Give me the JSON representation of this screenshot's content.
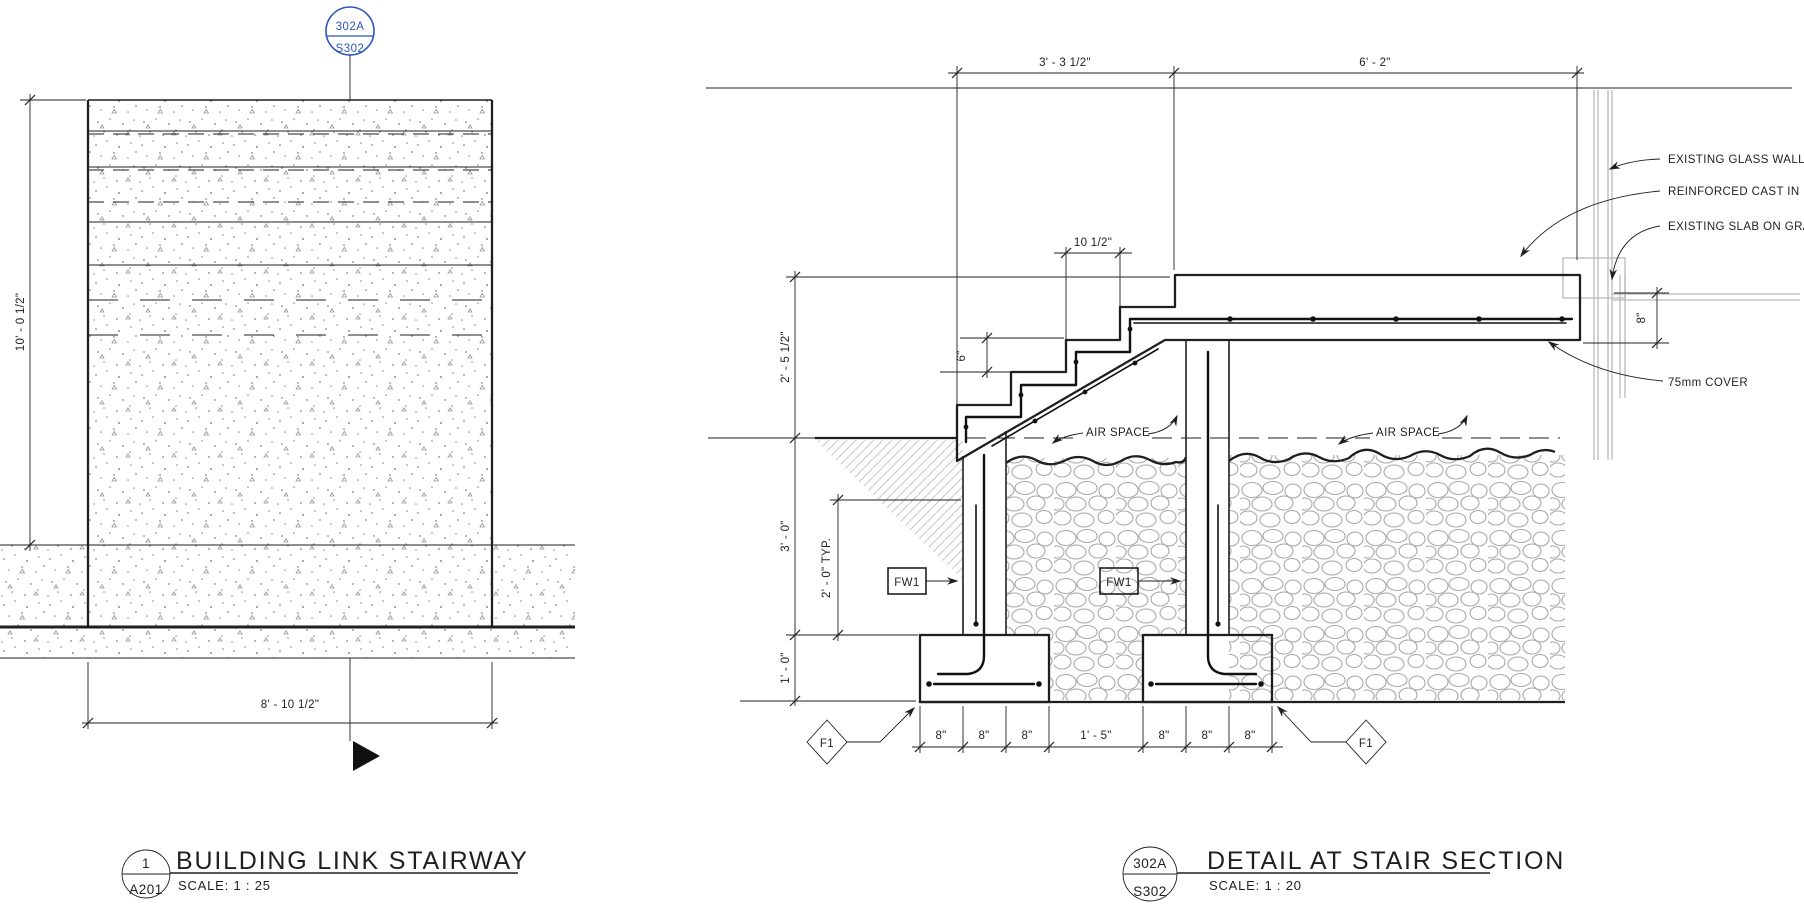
{
  "palette": {
    "ink": "#1f1f1f",
    "blue": "#2e55bd",
    "gray": "#b9b9b9"
  },
  "left_view": {
    "callout": {
      "detail": "302A",
      "sheet": "S302"
    },
    "dim_height": "10' - 0 1/2\"",
    "dim_width": "8' - 10 1/2\"",
    "title": {
      "number": "1",
      "sheet": "A201",
      "name": "BUILDING LINK STAIRWAY",
      "scale": "SCALE:  1 : 25"
    }
  },
  "right_view": {
    "dim_top_left": "3' - 3 1/2\"",
    "dim_top_right": "6' - 2\"",
    "dim_landing_height": "2' - 5 1/2\"",
    "dim_wall_height": "3' - 0\"",
    "dim_footing_height": "1' - 0\"",
    "dim_typ": "2' - 0\" TYP.",
    "dim_tread": "10 1/2\"",
    "dim_riser": "6\"",
    "dim_slab_thickness": "8\"",
    "dims_bottom": [
      "8\"",
      "8\"",
      "8\"",
      "1' - 5\"",
      "8\"",
      "8\"",
      "8\""
    ],
    "labels": {
      "glass_wall": "EXISTING GLASS WALL",
      "cast_in_place": "REINFORCED CAST IN PLA",
      "slab_on_grade": "EXISTING SLAB ON GRAD",
      "cover": "75mm COVER",
      "air_space_left": "AIR SPACE",
      "air_space_right": "AIR SPACE",
      "fw1_left": "FW1",
      "fw1_right": "FW1",
      "f1_left": "F1",
      "f1_right": "F1"
    },
    "title": {
      "number": "302A",
      "sheet": "S302",
      "name": "DETAIL AT STAIR SECTION",
      "scale": "SCALE:  1 : 20"
    }
  }
}
